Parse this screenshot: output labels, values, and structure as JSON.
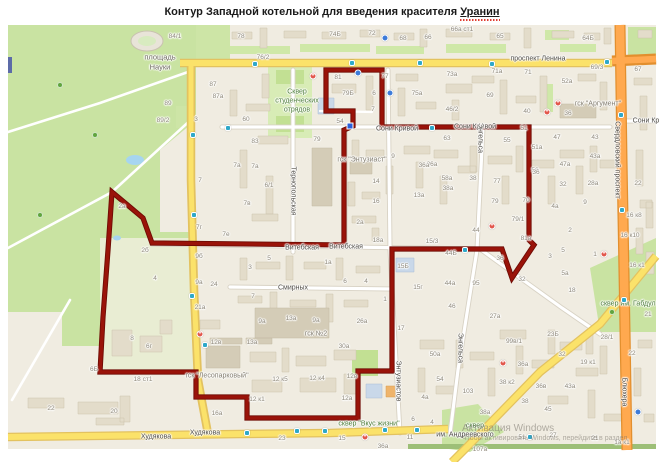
{
  "title": {
    "prefix": "Контур Западной котельной для введения красителя",
    "keyword": "Уранин"
  },
  "map": {
    "colors": {
      "background": "#F0ECE1",
      "park_green": "#C9E3A2",
      "road_yellow": "#FBE26A",
      "road_orange": "#FFA94F",
      "road_white": "#FFFFFF",
      "water_blue": "#A6D5F0",
      "contour_red": "#8A0E06"
    },
    "streets": [
      [
        "проспект Ленина",
        538,
        59,
        0
      ],
      [
        "Сони Кривой",
        397,
        129,
        0
      ],
      [
        "Сони Кривой",
        475,
        127,
        0
      ],
      [
        "Сони Кр",
        646,
        121,
        0
      ],
      [
        "Витебская",
        302,
        248,
        0
      ],
      [
        "Витебская",
        346,
        247,
        0
      ],
      [
        "Смирных",
        293,
        288,
        0
      ],
      [
        "Худякова",
        156,
        437,
        0
      ],
      [
        "Худякова",
        205,
        433,
        0
      ],
      [
        "им. Андреевского",
        465,
        435,
        0
      ],
      [
        "Тернопольская",
        293,
        191,
        1
      ],
      [
        "Энгельса",
        480,
        138,
        1
      ],
      [
        "Энгельса",
        460,
        348,
        1
      ],
      [
        "Энтузиастов",
        398,
        381,
        1
      ],
      [
        "Свердловский проспект",
        617,
        160,
        1
      ],
      [
        "Блюхера",
        624,
        392,
        1
      ]
    ],
    "places": [
      [
        "площадь",
        160,
        57,
        "pl"
      ],
      [
        "Науки",
        160,
        67,
        "pl"
      ],
      [
        "Сквер",
        297,
        92,
        "grn"
      ],
      [
        "студенческих",
        297,
        101,
        "grn"
      ],
      [
        "отрядов",
        297,
        110,
        "grn"
      ],
      [
        "гск \"Энтузиаст\"",
        362,
        160,
        "gray"
      ],
      [
        "гск \"Аргумент\"",
        598,
        104,
        "gray"
      ],
      [
        "гск №2",
        316,
        334,
        "gray"
      ],
      [
        "гск \"Лесопарковый\"",
        217,
        376,
        "gray"
      ],
      [
        "сквер \"Вкус жизни\"",
        369,
        424,
        "grn"
      ],
      [
        "сквер им. Габдул",
        628,
        304,
        "grn"
      ],
      [
        "сквер",
        475,
        426,
        "grn"
      ]
    ],
    "numbers": [
      [
        "84/1",
        175,
        37
      ],
      [
        "87",
        213,
        85
      ],
      [
        "89",
        168,
        104
      ],
      [
        "89/2",
        163,
        121
      ],
      [
        "3",
        196,
        120
      ],
      [
        "78",
        241,
        37
      ],
      [
        "76/2",
        263,
        58
      ],
      [
        "74Б",
        335,
        35
      ],
      [
        "72",
        372,
        34
      ],
      [
        "68",
        403,
        39
      ],
      [
        "66",
        428,
        38
      ],
      [
        "81",
        338,
        78
      ],
      [
        "79Б",
        348,
        94
      ],
      [
        "77",
        385,
        77
      ],
      [
        "6",
        374,
        94
      ],
      [
        "7",
        373,
        110
      ],
      [
        "75а",
        417,
        94
      ],
      [
        "87а",
        218,
        97
      ],
      [
        "60",
        246,
        120
      ],
      [
        "83",
        255,
        142
      ],
      [
        "79",
        317,
        140
      ],
      [
        "54",
        340,
        122
      ],
      [
        "7а",
        255,
        167
      ],
      [
        "36а",
        432,
        165
      ],
      [
        "66а ст1",
        462,
        30
      ],
      [
        "65",
        500,
        37
      ],
      [
        "64Б",
        588,
        39
      ],
      [
        "69/3",
        597,
        68
      ],
      [
        "67",
        638,
        70
      ],
      [
        "73а",
        452,
        75
      ],
      [
        "71а",
        497,
        72
      ],
      [
        "71",
        528,
        73
      ],
      [
        "52а",
        567,
        82
      ],
      [
        "69",
        490,
        96
      ],
      [
        "46/2",
        452,
        110
      ],
      [
        "40",
        527,
        112
      ],
      [
        "36",
        568,
        114
      ],
      [
        "63",
        447,
        139
      ],
      [
        "55",
        507,
        141
      ],
      [
        "51",
        524,
        129
      ],
      [
        "51а",
        537,
        148
      ],
      [
        "47",
        557,
        138
      ],
      [
        "43",
        595,
        138
      ],
      [
        "43а",
        595,
        157
      ],
      [
        "47а",
        565,
        165
      ],
      [
        "56",
        535,
        171
      ],
      [
        "7",
        200,
        181
      ],
      [
        "7г",
        199,
        228
      ],
      [
        "7е",
        226,
        235
      ],
      [
        "9б",
        199,
        257
      ],
      [
        "9а",
        199,
        283
      ],
      [
        "24",
        214,
        285
      ],
      [
        "21а",
        200,
        308
      ],
      [
        "2а",
        122,
        207
      ],
      [
        "2б",
        145,
        251
      ],
      [
        "4",
        155,
        279
      ],
      [
        "7а",
        237,
        166
      ],
      [
        "6/1",
        269,
        186
      ],
      [
        "7в",
        247,
        204
      ],
      [
        "5",
        269,
        259
      ],
      [
        "3",
        250,
        268
      ],
      [
        "1а",
        328,
        263
      ],
      [
        "14",
        376,
        182
      ],
      [
        "16",
        376,
        202
      ],
      [
        "2а",
        360,
        223
      ],
      [
        "18а",
        378,
        241
      ],
      [
        "13а",
        419,
        196
      ],
      [
        "36а",
        424,
        166
      ],
      [
        "9",
        393,
        157
      ],
      [
        "38а",
        448,
        189
      ],
      [
        "15/3",
        432,
        242
      ],
      [
        "15Б",
        403,
        267
      ],
      [
        "15г",
        418,
        288
      ],
      [
        "6",
        345,
        282
      ],
      [
        "4",
        366,
        282
      ],
      [
        "7",
        253,
        297
      ],
      [
        "1",
        385,
        300
      ],
      [
        "58а",
        447,
        179
      ],
      [
        "38",
        473,
        179
      ],
      [
        "77",
        497,
        182
      ],
      [
        "79",
        495,
        202
      ],
      [
        "70",
        526,
        201
      ],
      [
        "79/1",
        518,
        220
      ],
      [
        "44",
        476,
        231
      ],
      [
        "81а",
        526,
        239
      ],
      [
        "44Б",
        451,
        254
      ],
      [
        "36",
        500,
        259
      ],
      [
        "44а",
        450,
        284
      ],
      [
        "95",
        476,
        284
      ],
      [
        "46",
        452,
        307
      ],
      [
        "27а",
        495,
        317
      ],
      [
        "32",
        522,
        280
      ],
      [
        "36",
        536,
        173
      ],
      [
        "32",
        563,
        185
      ],
      [
        "28а",
        593,
        184
      ],
      [
        "22",
        638,
        184
      ],
      [
        "9",
        585,
        203
      ],
      [
        "4а",
        555,
        207
      ],
      [
        "2",
        570,
        231
      ],
      [
        "5",
        563,
        251
      ],
      [
        "3",
        550,
        257
      ],
      [
        "1",
        595,
        255
      ],
      [
        "5а",
        565,
        274
      ],
      [
        "18",
        572,
        291
      ],
      [
        "16 к8",
        634,
        216
      ],
      [
        "16 к10",
        630,
        236
      ],
      [
        "16 к1",
        637,
        266
      ],
      [
        "21",
        648,
        315
      ],
      [
        "22",
        51,
        409
      ],
      [
        "20",
        114,
        412
      ],
      [
        "6Б",
        94,
        370
      ],
      [
        "8",
        132,
        339
      ],
      [
        "6г",
        149,
        347
      ],
      [
        "18 ст1",
        143,
        380
      ],
      [
        "16а",
        217,
        414
      ],
      [
        "12в",
        216,
        343
      ],
      [
        "13а",
        252,
        343
      ],
      [
        "9а",
        262,
        322
      ],
      [
        "13а",
        291,
        319
      ],
      [
        "9а",
        316,
        321
      ],
      [
        "26а",
        362,
        322
      ],
      [
        "17",
        401,
        329
      ],
      [
        "30а",
        344,
        347
      ],
      [
        "12 к5",
        280,
        380
      ],
      [
        "12 к4",
        317,
        379
      ],
      [
        "12 к1",
        257,
        400
      ],
      [
        "12а",
        347,
        399
      ],
      [
        "12в",
        352,
        377
      ],
      [
        "23",
        282,
        439
      ],
      [
        "15",
        342,
        439
      ],
      [
        "36а",
        383,
        447
      ],
      [
        "11",
        410,
        438
      ],
      [
        "6",
        413,
        420
      ],
      [
        "4",
        432,
        423
      ],
      [
        "50а",
        435,
        355
      ],
      [
        "54",
        440,
        380
      ],
      [
        "4а",
        425,
        398
      ],
      [
        "103",
        468,
        392
      ],
      [
        "99в/1",
        514,
        342
      ],
      [
        "36а",
        523,
        365
      ],
      [
        "38 к2",
        507,
        383
      ],
      [
        "36в",
        541,
        387
      ],
      [
        "38",
        525,
        402
      ],
      [
        "38а",
        485,
        413
      ],
      [
        "23Б",
        553,
        335
      ],
      [
        "32",
        562,
        355
      ],
      [
        "19 к1",
        588,
        363
      ],
      [
        "28/1",
        607,
        338
      ],
      [
        "22",
        632,
        354
      ],
      [
        "43а",
        570,
        387
      ],
      [
        "45",
        548,
        410
      ],
      [
        "51",
        522,
        438
      ],
      [
        "27",
        553,
        436
      ],
      [
        "21",
        595,
        439
      ],
      [
        "1а к1",
        622,
        443
      ],
      [
        "107а",
        480,
        450
      ]
    ],
    "icons": {
      "bus": [
        [
          255,
          64
        ],
        [
          352,
          63
        ],
        [
          420,
          63
        ],
        [
          492,
          64
        ],
        [
          607,
          62
        ],
        [
          228,
          128
        ],
        [
          432,
          128
        ],
        [
          465,
          250
        ],
        [
          193,
          135
        ],
        [
          194,
          215
        ],
        [
          192,
          296
        ],
        [
          205,
          345
        ],
        [
          247,
          433
        ],
        [
          297,
          431
        ],
        [
          325,
          431
        ],
        [
          385,
          430
        ],
        [
          417,
          430
        ],
        [
          530,
          437
        ],
        [
          621,
          115
        ],
        [
          622,
          210
        ],
        [
          624,
          300
        ]
      ],
      "pharmacy": [
        [
          313,
          76
        ],
        [
          547,
          112
        ],
        [
          492,
          226
        ],
        [
          604,
          254
        ],
        [
          200,
          334
        ],
        [
          503,
          363
        ],
        [
          365,
          437
        ],
        [
          558,
          103
        ]
      ],
      "poi": [
        [
          358,
          73
        ],
        [
          390,
          93
        ],
        [
          385,
          38
        ],
        [
          638,
          412
        ]
      ],
      "tree": [
        [
          60,
          85
        ],
        [
          95,
          135
        ],
        [
          40,
          215
        ],
        [
          612,
          312
        ]
      ]
    },
    "contour": {
      "color": "#8A0E06",
      "points": [
        [
          112,
          192
        ],
        [
          143,
          218
        ],
        [
          152,
          243
        ],
        [
          344,
          245
        ],
        [
          344,
          130
        ],
        [
          353,
          126
        ],
        [
          353,
          111
        ],
        [
          326,
          111
        ],
        [
          326,
          70
        ],
        [
          382,
          70
        ],
        [
          382,
          127
        ],
        [
          529,
          127
        ],
        [
          529,
          240
        ],
        [
          534,
          245
        ],
        [
          512,
          278
        ],
        [
          502,
          249
        ],
        [
          392,
          249
        ],
        [
          392,
          371
        ],
        [
          358,
          371
        ],
        [
          358,
          418
        ],
        [
          247,
          418
        ],
        [
          247,
          397
        ],
        [
          196,
          397
        ],
        [
          196,
          372
        ],
        [
          100,
          372
        ],
        [
          103,
          317
        ],
        [
          108,
          250
        ]
      ],
      "marker": {
        "x": 350,
        "y": 126
      }
    },
    "watermark": {
      "line1": "Активация Windows",
      "line2": "Чтобы активировать Windows, перейдите в раздел"
    }
  }
}
